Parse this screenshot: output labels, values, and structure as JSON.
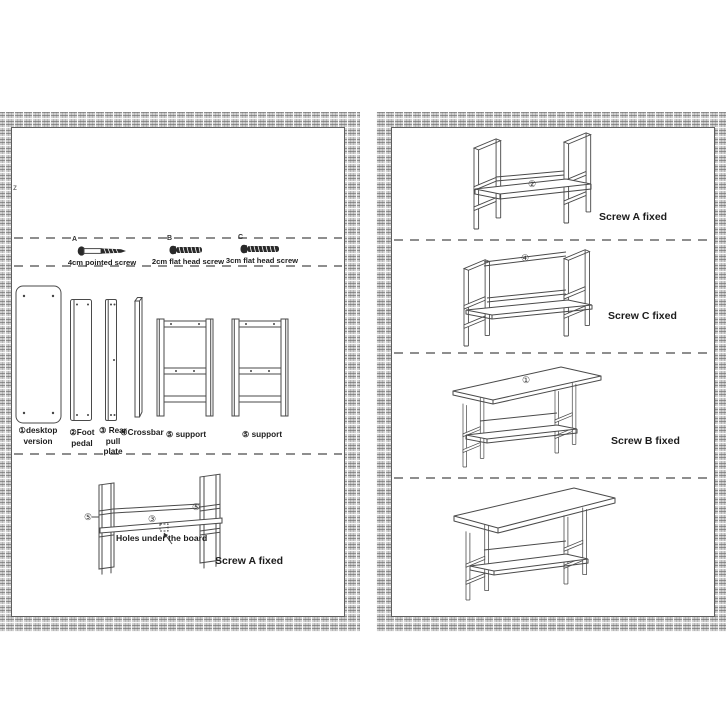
{
  "left_page": {
    "stray_mark": "z",
    "screws": [
      {
        "id": "A",
        "name": "4cm pointed screw"
      },
      {
        "id": "B",
        "name": "2cm flat head screw"
      },
      {
        "id": "C",
        "name": "3cm flat head screw"
      }
    ],
    "parts": [
      {
        "label": "①desktop\nversion"
      },
      {
        "label": "②Foot\npedal"
      },
      {
        "label": "③ Rear\npull\nplate"
      },
      {
        "label": "④Crossbar"
      },
      {
        "label": "⑤ support"
      },
      {
        "label": "⑤ support"
      }
    ],
    "assembly": {
      "callout_left": "⑤",
      "callout_center": "③",
      "callout_right": "⑤",
      "holes_note": "Holes under the board",
      "screw_note": "Screw A fixed"
    }
  },
  "right_page": {
    "steps": [
      {
        "callout": "②",
        "note": "Screw A fixed"
      },
      {
        "callout": "④",
        "note": "Screw C fixed"
      },
      {
        "callout": "①",
        "note": "Screw B fixed"
      },
      {
        "callout": "",
        "note": ""
      }
    ]
  }
}
